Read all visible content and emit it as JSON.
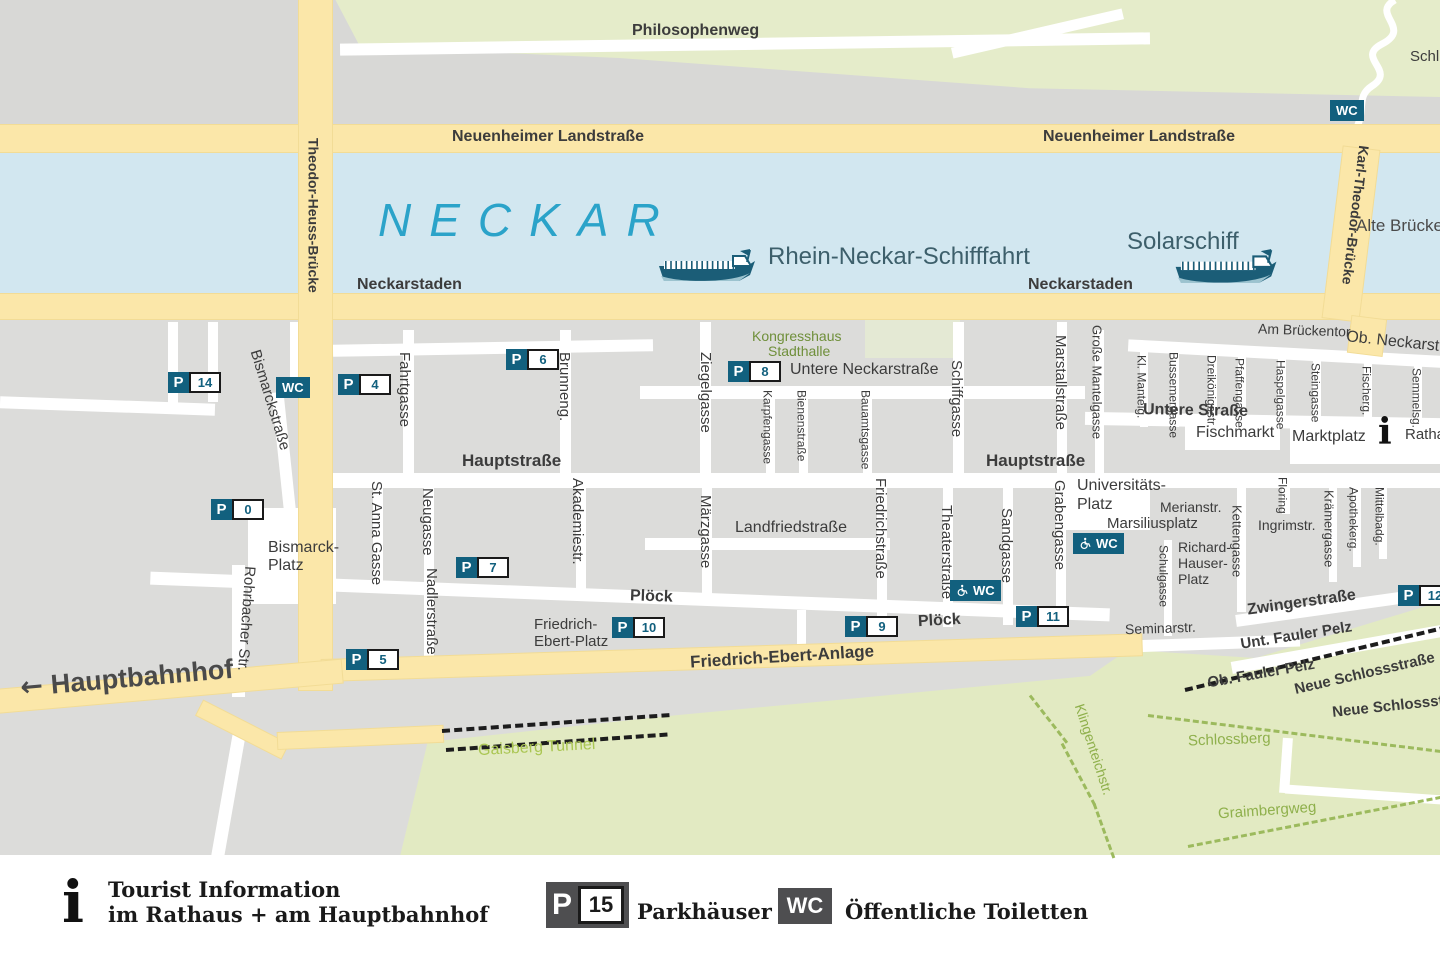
{
  "badge": {
    "p": "P",
    "wc": "WC"
  },
  "parking": {
    "p0": "0",
    "p4": "4",
    "p5": "5",
    "p6": "6",
    "p7": "7",
    "p8": "8",
    "p9": "9",
    "p10": "10",
    "p11": "11",
    "p12": "12",
    "p14": "14"
  },
  "river": {
    "name": "NECKAR",
    "cruise": "Rhein-Neckar-Schifffahrt",
    "solar": "Solarschiff"
  },
  "labels": {
    "philosophenweg": "Philosophenweg",
    "schl": "Schl",
    "neuenheimer_w": "Neuenheimer Landstraße",
    "neuenheimer_e": "Neuenheimer Landstraße",
    "theodor_heuss": "Theodor-Heuss-Brücke",
    "karl_theodor": "Karl-Theodor-Brücke",
    "alte_bruecke": "Alte Brücke",
    "neckarstaden_w": "Neckarstaden",
    "neckarstaden_e": "Neckarstaden",
    "arrow": "←",
    "hauptbahnhof": "Hauptbahnhof",
    "bismarckstrasse": "Bismarckstraße",
    "bismarck_platz1": "Bismarck-",
    "bismarck_platz2": "Platz",
    "rohrbacher": "Rohrbacher Str.",
    "fahrtgasse": "Fahrtgasse",
    "st_anna": "St. Anna Gasse",
    "neugasse": "Neugasse",
    "nadlerstrasse": "Nadlerstraße",
    "brunneng": "Brunneng.",
    "akademiestr": "Akademiestr.",
    "hauptstrasse_w": "Hauptstraße",
    "hauptstrasse_e": "Hauptstraße",
    "ploeck_w": "Plöck",
    "ploeck_e": "Plöck",
    "landfriedstrasse": "Landfriedstraße",
    "untere_neckarstrasse": "Untere Neckarstraße",
    "kongresshaus1": "Kongresshaus",
    "kongresshaus2": "Stadthalle",
    "ziegelgasse": "Ziegelgasse",
    "karpfengasse": "Karpfengasse",
    "bienenstrasse": "Bienenstraße",
    "bauamtsgasse": "Bauamtsgasse",
    "maerzgasse": "Märzgasse",
    "friedrichstrasse": "Friedrichstraße",
    "schiffgasse": "Schiffgasse",
    "theaterstrasse": "Theaterstraße",
    "sandgasse": "Sandgasse",
    "grabengasse": "Grabengasse",
    "marstallstrasse": "Marstallstraße",
    "grosse_mantelgasse": "Große Mantelgasse",
    "kl_mantelg": "Kl. Mantelg.",
    "bussemergasse": "Bussemergasse",
    "dreikoenigsstr": "Dreikönigsstr.",
    "pfaffengasse": "Pfaffengasse",
    "haspelgasse": "Haspelgasse",
    "steingasse": "Steingasse",
    "fischerg": "Fischerg.",
    "semmelsg": "Semmelsg.",
    "am_brueckentor": "Am Brückentor",
    "ob_neckarstr": "Ob. Neckarst",
    "untere_strasse": "Untere Straße",
    "fischmarkt": "Fischmarkt",
    "marktplatz": "Marktplatz",
    "info_i": "i",
    "rathaus": "Ratha",
    "universitaets1": "Universitäts-",
    "universitaets2": "Platz",
    "merianstr": "Merianstr.",
    "marsiliusplatz": "Marsiliusplatz",
    "richard1": "Richard-",
    "richard2": "Hauser-",
    "richard3": "Platz",
    "schulgasse": "Schulgasse",
    "kettengasse": "Kettengasse",
    "floring": "Floring",
    "ingrimstr": "Ingrimstr.",
    "kraemergasse": "Krämergasse",
    "apothekerg": "Apothekerg.",
    "mittelbadg": "Mittelbadg.",
    "zwingerstrasse": "Zwingerstraße",
    "unt_fauler_pelz": "Unt. Fauler Pelz",
    "ob_fauler_pelz": "Ob. Fauler Pelz",
    "neue_schlossstrasse": "Neue Schlossstraße",
    "neue_schlossst": "Neue Schlossst",
    "seminarstr": "Seminarstr.",
    "friedrich_ebert_anlage": "Friedrich-Ebert-Anlage",
    "fe_platz1": "Friedrich-",
    "fe_platz2": "Ebert-Platz",
    "gaisberg_tunnel": "Gaisberg Tunnel",
    "klingenteichstr": "Klingenteichstr.",
    "schlossberg": "Schlossberg",
    "graimbergweg": "Graimbergweg"
  },
  "legend": {
    "info_icon": "i",
    "tourist_line1": "Tourist Information",
    "tourist_line2": "im Rathaus + am Hauptbahnhof",
    "parking_p": "P",
    "parking_number": "15",
    "parking_label": "Parkhäuser",
    "wc": "WC",
    "wc_label": "Öffentliche Toiletten"
  }
}
